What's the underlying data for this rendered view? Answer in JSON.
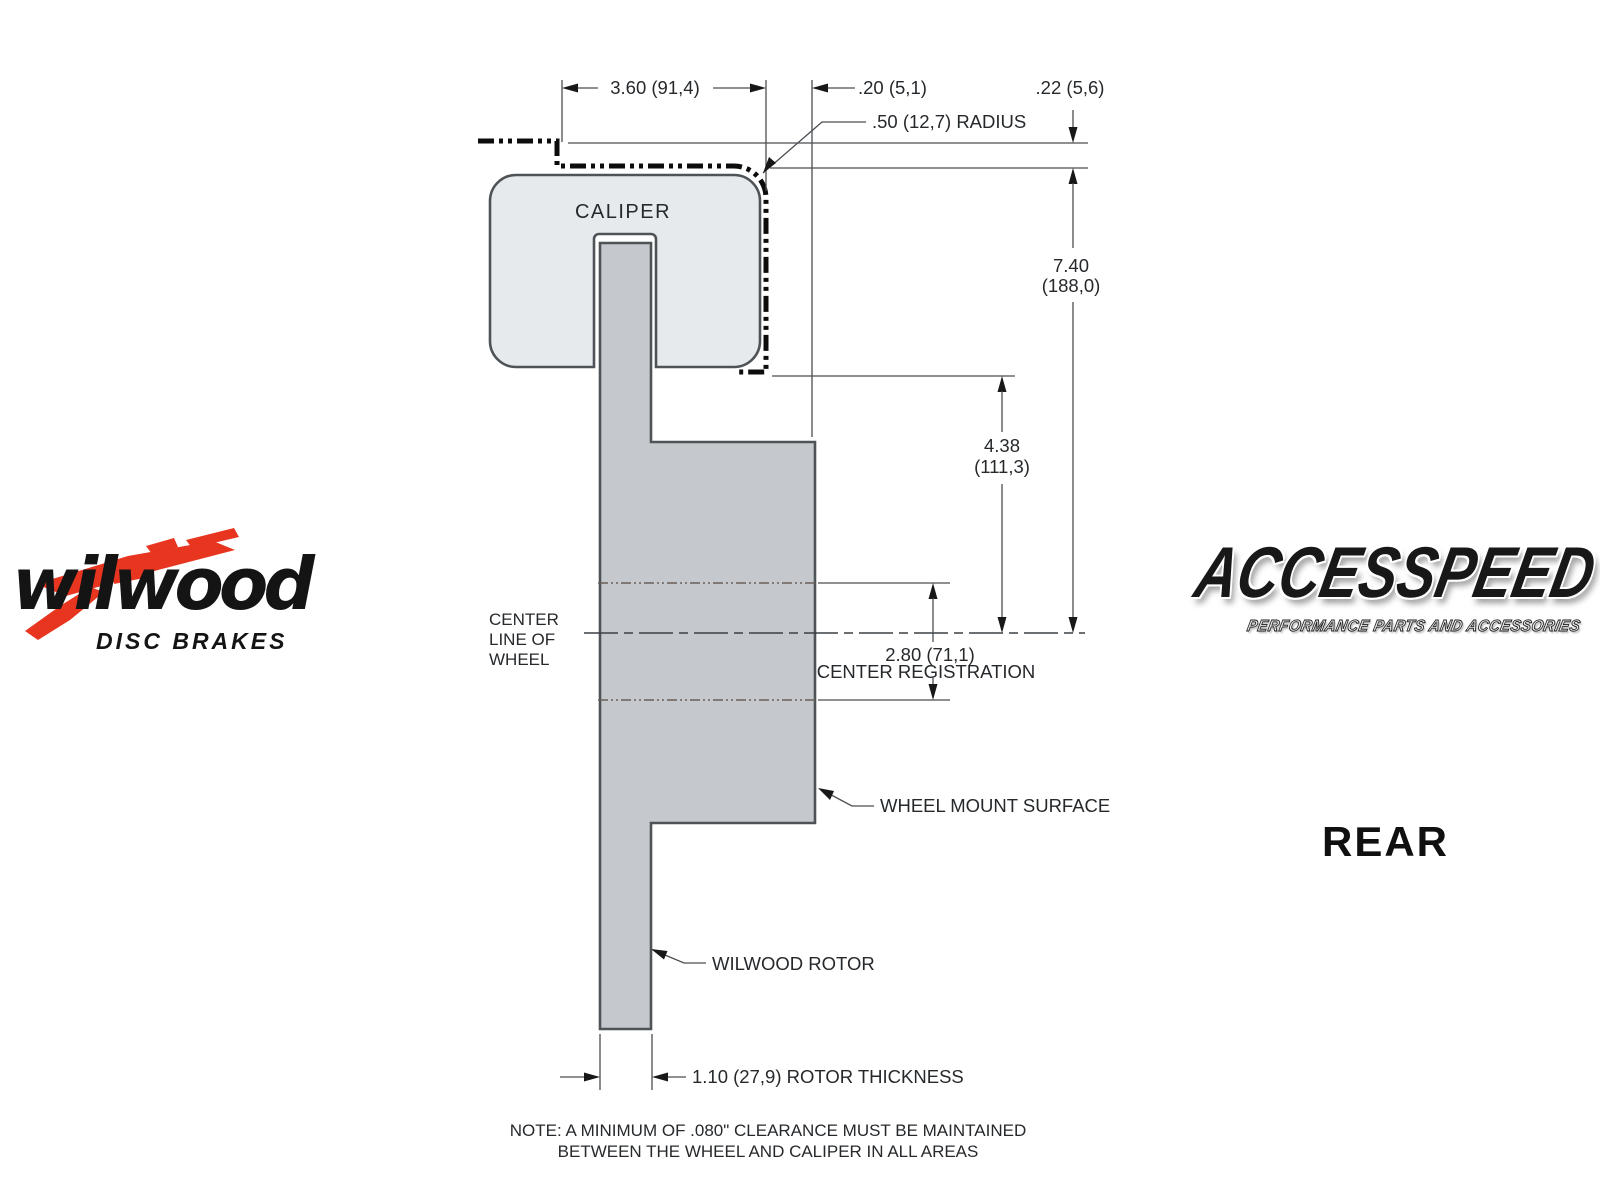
{
  "drawing": {
    "caliper_label": "CALIPER",
    "dims": {
      "width_360": "3.60 (91,4)",
      "offset_20": ".20 (5,1)",
      "gap_22": ".22 (5,6)",
      "radius_50": ".50 (12,7) RADIUS",
      "height_740_in": "7.40",
      "height_740_mm": "(188,0)",
      "height_438_in": "4.38",
      "height_438_mm": "(111,3)",
      "reg_280": "2.80 (71,1)",
      "reg_caption": "CENTER REGISTRATION",
      "rotor_thickness": "1.10 (27,9) ROTOR THICKNESS"
    },
    "labels": {
      "centerline_1": "CENTER",
      "centerline_2": "LINE OF",
      "centerline_3": "WHEEL",
      "wheel_mount": "WHEEL MOUNT SURFACE",
      "wilwood_rotor": "WILWOOD ROTOR"
    },
    "note_line1": "NOTE: A MINIMUM OF .080\" CLEARANCE MUST BE MAINTAINED",
    "note_line2": "BETWEEN THE WHEEL AND CALIPER IN ALL AREAS"
  },
  "branding": {
    "wilwood_name": "wilwood",
    "wilwood_tagline": "DISC BRAKES",
    "accesspeed_name": "ACCESSPEED",
    "accesspeed_tagline": "PERFORMANCE PARTS AND ACCESSORIES",
    "view_label": "REAR"
  },
  "colors": {
    "background": "#ffffff",
    "caliper_fill": "#e7eaed",
    "rotor_fill": "#c5c9cd",
    "outline": "#4e5357",
    "dimension_line": "#4a4e52",
    "phantom_line": "#0c0c0c",
    "text": "#26292c",
    "wilwood_red": "#e8351f"
  }
}
